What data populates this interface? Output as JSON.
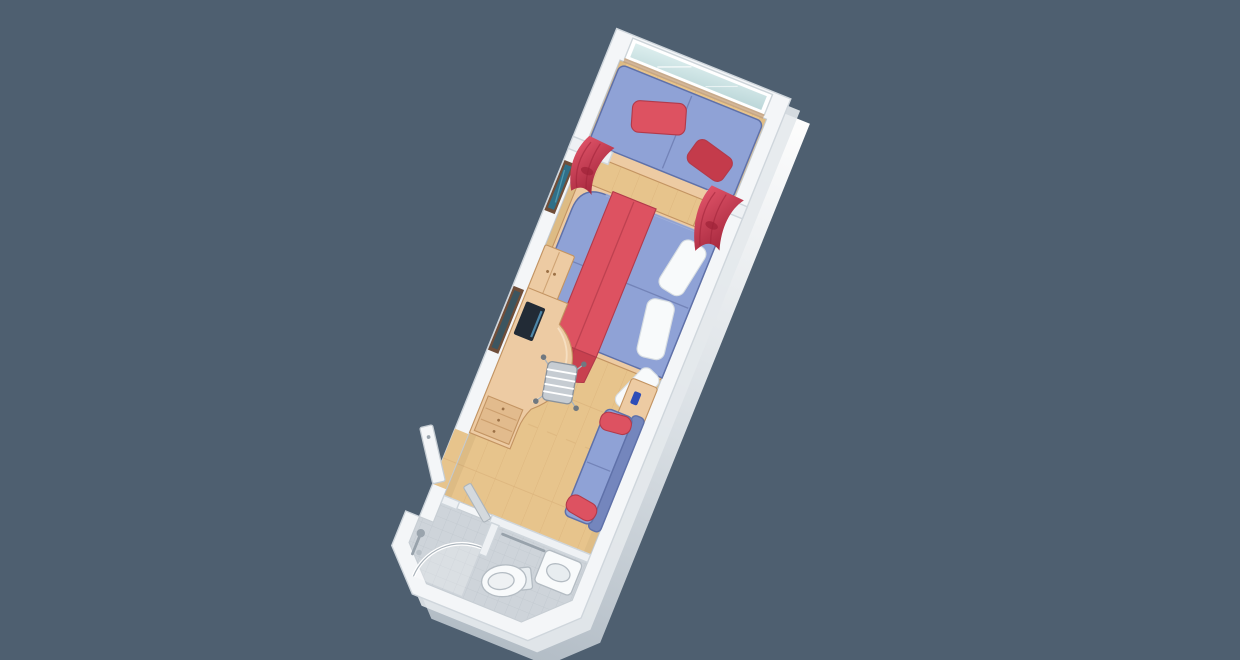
{
  "scene": {
    "type": "isometric-floorplan-render",
    "subject": "single cruise-ship cabin stateroom with balcony window, seen from above at an angle",
    "elements": [
      "balcony-window",
      "window-daybed",
      "daybed-red-pillows",
      "red-curtains-left",
      "red-curtain-right",
      "wall-picture",
      "double-bed",
      "bed-red-runner",
      "bed-white-pillows",
      "nightstand-upper",
      "nightstand-lower",
      "phone-on-nightstand",
      "wall-mirror",
      "tv-on-desk",
      "desk-with-curved-top",
      "desk-drawers",
      "desk-chair",
      "wardrobe",
      "sofa-with-red-bolsters",
      "entrance-door-open",
      "bathroom-door-ajar",
      "bathroom-tile-floor",
      "shower-with-curved-glass",
      "shower-fixture",
      "toilet",
      "sink-counter",
      "towel-rail",
      "wood-floor"
    ]
  },
  "palette": {
    "background": "#4e5f70",
    "wallFill": "#f4f6f8",
    "wallStrip": "#eef1f4",
    "extrusionLight": "#fdfdfd",
    "extrusionDark": "#b3bdc6",
    "floorWood": "#e7c48c",
    "plankLine": "#d5ab72",
    "tileFloor": "#ced4da",
    "tileLine": "#bdc4cb",
    "bedBlue": "#8fa2d6",
    "blueDark": "#6274ae",
    "sofaBackBlue": "#7486bd",
    "accentRed": "#dd5261",
    "redDark": "#c8404f",
    "curtainRed": "#c4304a",
    "curtainDeep": "#9e2238",
    "furnitureWood": "#edcba3",
    "woodEdge": "#c39462",
    "linenWhite": "#f8fafb",
    "glassBlue": "#cfe2e2",
    "artTeal": "#2f6f88",
    "frameBrown": "#6f4e3a",
    "metalGray": "#9aa4ad",
    "screenDark": "#222b36",
    "doorGray": "#d4d9dd"
  }
}
